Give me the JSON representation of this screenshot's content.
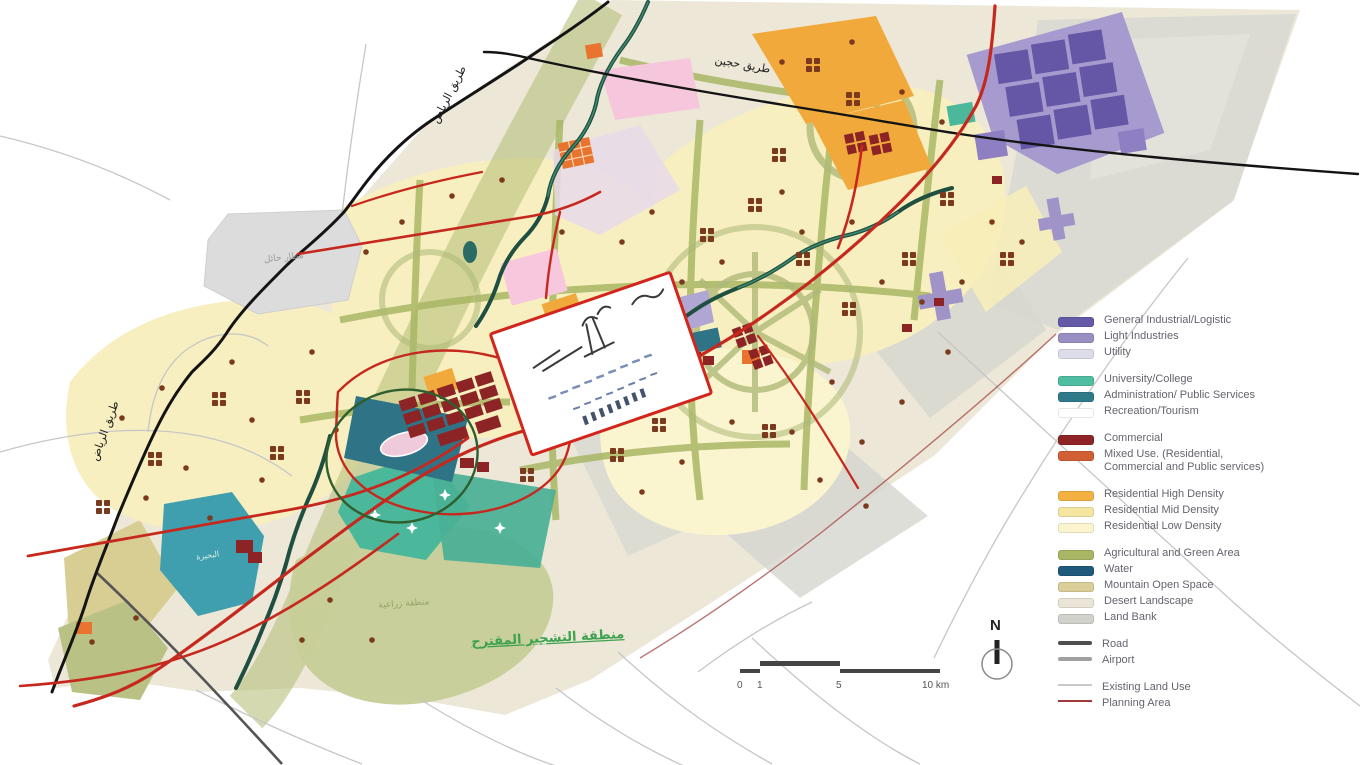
{
  "legend": {
    "items": [
      {
        "label": "General Industrial/Logistic",
        "color": "#655aa5",
        "type": "swatch",
        "gap": false
      },
      {
        "label": "Light Industries",
        "color": "#998fc2",
        "type": "swatch",
        "gap": false
      },
      {
        "label": "Utility",
        "color": "#dcdde8",
        "type": "swatch",
        "gap": false
      },
      {
        "label": "University/College",
        "color": "#4fbda0",
        "type": "swatch",
        "gap": true
      },
      {
        "label": "Administration/ Public Services",
        "color": "#2f7a8a",
        "type": "swatch",
        "gap": false
      },
      {
        "label": "Recreation/Tourism",
        "color": "#ffffff",
        "type": "swatch",
        "gap": false
      },
      {
        "label": "Commercial",
        "color": "#8e2425",
        "type": "swatch",
        "gap": true
      },
      {
        "label": "Mixed Use. (Residential,",
        "label2": "Commercial and Public services)",
        "color": "#d05f35",
        "type": "swatch",
        "gap": false
      },
      {
        "label": "Residential High Density",
        "color": "#f4b143",
        "type": "swatch",
        "gap": true
      },
      {
        "label": "Residential Mid Density",
        "color": "#f4e5a3",
        "type": "swatch",
        "gap": false
      },
      {
        "label": "Residential Low Density",
        "color": "#fbf4cf",
        "type": "swatch",
        "gap": false
      },
      {
        "label": "Agricultural and Green Area",
        "color": "#a9b765",
        "type": "swatch",
        "gap": true
      },
      {
        "label": "Water",
        "color": "#1f5a7d",
        "type": "swatch",
        "gap": false
      },
      {
        "label": "Mountain Open Space",
        "color": "#d9cf97",
        "type": "swatch",
        "gap": false
      },
      {
        "label": "Desert Landscape",
        "color": "#eae5d6",
        "type": "swatch",
        "gap": false
      },
      {
        "label": "Land Bank",
        "color": "#d2d2cc",
        "type": "swatch",
        "gap": false
      },
      {
        "label": "Road",
        "color": "#4f4f4f",
        "type": "line-thick",
        "gap": true
      },
      {
        "label": "Airport",
        "color": "#a0a0a0",
        "type": "line-thick",
        "gap": false
      },
      {
        "label": "Existing Land Use",
        "color": "#c9c9c9",
        "type": "line-thin",
        "gap": true
      },
      {
        "label": "Planning Area",
        "color": "#a03a3a",
        "type": "line-thin",
        "gap": false
      }
    ]
  },
  "map": {
    "labels": {
      "riyadh_road_top": "طريق الرياض",
      "riyadh_road_left": "طريق الرياض",
      "north_road": "طريق حجين",
      "airport": "مطار حائل",
      "lake": "البحيرة",
      "farm_area": "منطقة زراعية",
      "afforestation_area": "منطقة التشجير المقترح"
    },
    "scale_bar": {
      "ticks": [
        "0",
        "1",
        "5",
        "10 km"
      ]
    },
    "north": "N"
  }
}
